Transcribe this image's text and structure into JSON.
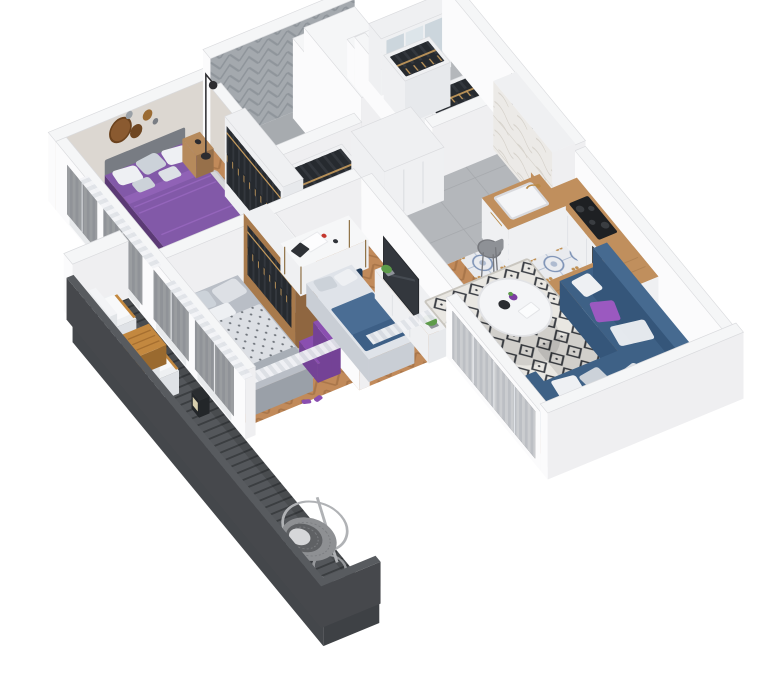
{
  "image": {
    "kind": "3d-isometric-apartment-floor-plan-render",
    "background": "#ffffff"
  },
  "rooms": [
    {
      "id": "master-bedroom",
      "furniture": [
        "double-bed-purple",
        "pillows",
        "nightstand-left",
        "nightstand-right",
        "area-rug",
        "wall-decor-circles",
        "floor-lamp",
        "open-wardrobe"
      ]
    },
    {
      "id": "bathroom",
      "furniture": [
        "herringbone-tile-walls",
        "white-column"
      ]
    },
    {
      "id": "walk-in-closet",
      "furniture": [
        "mirror-wardrobe",
        "clothes-rack-1",
        "clothes-rack-2"
      ]
    },
    {
      "id": "hallway",
      "furniture": [
        "clothes-rack",
        "white-cabinet",
        "entrance-door",
        "butterfly-art",
        "sink-unit"
      ]
    },
    {
      "id": "kitchen",
      "furniture": [
        "wood-counter",
        "cooktop",
        "oven",
        "bar-table",
        "bar-chairs",
        "green-plate",
        "tall-cabinet"
      ]
    },
    {
      "id": "living-room",
      "furniture": [
        "corner-sofa-blue",
        "cushions",
        "round-coffee-table",
        "diamond-rug",
        "curtains"
      ]
    },
    {
      "id": "bedroom-2",
      "furniture": [
        "double-bed-gray",
        "purple-armchair",
        "wood-wardrobe",
        "curtains"
      ]
    },
    {
      "id": "kids-room-office",
      "furniture": [
        "desk",
        "office-chair",
        "single-bed",
        "tv-sideboard",
        "plants",
        "curtains"
      ]
    },
    {
      "id": "balcony",
      "furniture": [
        "deck-planks",
        "railing",
        "lounge-chair-1",
        "lounge-chair-2",
        "wood-table",
        "lantern",
        "hanging-egg-chair"
      ]
    }
  ],
  "palette": {
    "wallTop": "#f5f6f7",
    "wallSouth": "#efeff1",
    "wallWest": "#fbfbfc",
    "edge": "#dadbde",
    "greige": "#dcd7d1",
    "bathHerrBase": "#a4a9ae",
    "bathHerrLine": "#8f959b",
    "woodBase": "#c18a5a",
    "woodLine": "#a9764a",
    "tileGray": "#b4b7bb",
    "tileGrayLine": "#a5a8ac",
    "bathFloor": "#a7abaf",
    "tileBlueBase": "#e9ebef",
    "tileBlueInk": "#7e93b6",
    "tileBlueGold": "#bf8f52",
    "deckBase": "#54575b",
    "deckGap": "#3b3e41",
    "deckSkirt": "#44474b",
    "rail": "#46484c",
    "railTop": "#585b5f",
    "baluster": "#3c3f43",
    "counterWood": "#c08f5d",
    "counterWoodLine": "#a87c4e",
    "cabWhite": "#eff0f2",
    "cabLite": "#e7e9ec",
    "cabLine": "#dcdee2",
    "clothesDark": "#33373d",
    "clothesDeep": "#262a2f",
    "hanger": "#c59a5c",
    "mirror1": "#ccd6dd",
    "mirror2": "#dde5ea",
    "marble": "#eceae7",
    "marbleVein": "#d6d2cb",
    "bedPurple": "#8259a8",
    "bedPurpleDark": "#6a4488",
    "bedPurpleSide": "#5b3a75",
    "purpleFold": "#9465bb",
    "pillowWhite": "#eef0f3",
    "pillowGray": "#ccd2d9",
    "headboard": "#787c83",
    "nightWood": "#b68a5c",
    "nightWoodDark": "#97704a",
    "rug1": "#d6d7d9",
    "rugEdge": "#c7c8cb",
    "bed2Top": "#b9bec6",
    "bed2Side": "#9aa0a8",
    "blanketBase": "#dcdfe4",
    "blanketDot": "#70757c",
    "purpleChair": "#8a4fb0",
    "purpleChairDark": "#744296",
    "woodWard": "#a87a4c",
    "woodWardDark": "#8f6640",
    "deskTop": "#f6f7f8",
    "chairNavy": "#2b4766",
    "chairNavyDark": "#223c5a",
    "bedKidTop": "#dfe3e9",
    "bedKidBlue": "#4a6d94",
    "bedKidNavy": "#3d5f86",
    "tv": "#33373d",
    "tvEdge": "#24272b",
    "sofa": "#3e6186",
    "sofaDark": "#2f4e6e",
    "sofaSide": "#35567a",
    "sofaBack": "#466a90",
    "cushPurple": "#9b59c0",
    "tableWhite": "#f4f5f7",
    "tableEdge": "#e2e3e6",
    "plantGreen": "#5d9b4a",
    "plantDark": "#3f7a33",
    "pot": "#8f939a",
    "plateGreen": "#63b32e",
    "plateRim": "#2a2d30",
    "chairGray": "#8e9196",
    "chairGrayDark": "#77797e",
    "cooktop": "#1e2023",
    "burner": "#3a3d41",
    "oven": "#26292d",
    "ovenSteel": "#b9bcc0",
    "glass": "#2f3337",
    "mullion": "#e8eaec",
    "radiator": "#e8eaec",
    "curt1": "#f2f3f6",
    "curt2": "#dfe2e7",
    "doorWhite": "#f1f2f4",
    "doorLine": "#d9dbde",
    "handle": "#9a9a9e",
    "frame": "#47484c",
    "butterfly": "#3c3e44",
    "artPaper": "#fdfdfe",
    "lampBlack": "#2c2c30",
    "eggRattan": "#8e9093",
    "eggInner": "#5f6164",
    "eggCushion": "#d6d7d9",
    "eggStand": "#b0b2b5",
    "outTableWood": "#c3883f",
    "outTableLine": "#a66f30",
    "sink": "#f4f5f7",
    "sinkEdge": "#d9dade",
    "brass": "#b98a46",
    "laptop": "#2e3136",
    "red": "#c4372e",
    "shadow": "rgba(0,0,0,0.10)"
  }
}
